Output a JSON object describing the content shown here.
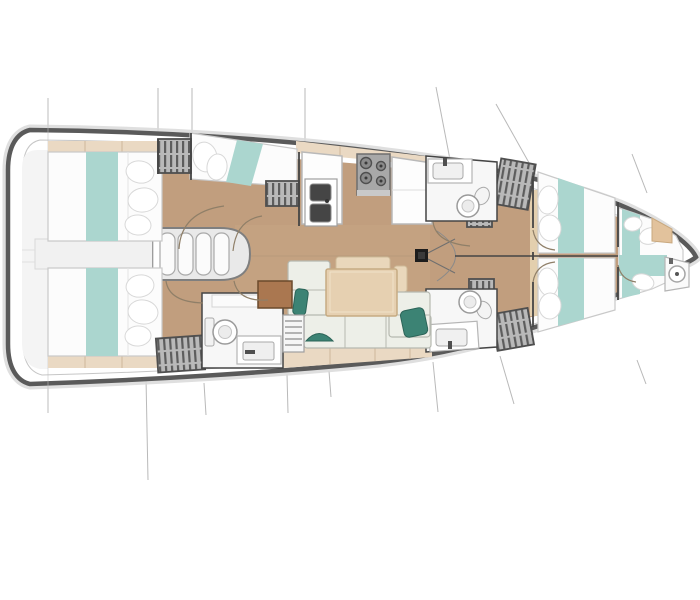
{
  "meta": {
    "title": "Sailboat interior layout plan",
    "type": "floorplan",
    "view": "top-down",
    "orientation": "bow-right"
  },
  "palette": {
    "page": "#ffffff",
    "hull_outline": "#5a5a5a",
    "hull_shadow": "#d9d9d9",
    "hull_inner_line": "#c6c6c6",
    "deck": "#ffffff",
    "transom": "#f4f4f4",
    "floor_wood": "#c19e7e",
    "floor_wood_light": "#cdab89",
    "forepeak_floor": "#efefef",
    "trim_beige": "#ead9c3",
    "trim_line": "#cdb69b",
    "shelf_tan": "#e3cfae",
    "locker_tan": "#e2c29c",
    "mattress": "#fcfcfc",
    "mattress_line": "#c9c9c9",
    "runner_teal": "#abd6cf",
    "pillow_teal": "#3c8374",
    "pillow_teal_line": "#2c6458",
    "cushion": "#edefe8",
    "cushion_line": "#b6b9b0",
    "backrest_tan": "#e9d7bb",
    "backrest_line": "#cfbb99",
    "table_wood": "#e6d0b1",
    "table_line": "#c6ab83",
    "wardrobe_fill": "#b9b9b9",
    "wardrobe_mark": "#5d5d5d",
    "wardrobe_frame": "#4f4f4f",
    "fixture_white": "#f7f7f7",
    "fixture_line": "#9a9a9a",
    "counter_white": "#fdfdfd",
    "counter_line": "#b9b9b9",
    "stove_gray": "#a8a8a8",
    "stove_line": "#6e6e6e",
    "burner_gray": "#8b8b8b",
    "basin_dark": "#454545",
    "stairs_frame": "#7f7f7f",
    "stairs_fill": "#e9e9e9",
    "tread_white": "#fbfbfb",
    "mast_black": "#1d1d1d",
    "wall": "#454545",
    "door_arc": "#8f7f68",
    "section_line": "#b9b9b9",
    "ottoman_brown": "#aa7750",
    "ottoman_line": "#6b4a2c"
  },
  "layout": {
    "areas": [
      {
        "name": "aft-cabin-port",
        "features": [
          "transom-double-berth",
          "teal-runner",
          "hanging-wardrobe",
          "second-berth-angled",
          "hanging-wardrobe-2"
        ]
      },
      {
        "name": "aft-cabin-starboard",
        "features": [
          "transom-double-berth",
          "teal-runner",
          "hanging-wardrobe",
          "ensuite-head"
        ]
      },
      {
        "name": "companionway",
        "features": [
          "four-steps",
          "landing",
          "cockpit-passage"
        ]
      },
      {
        "name": "galley",
        "features": [
          "double-sink",
          "four-burner-stove",
          "counter-left",
          "counter-right",
          "shelf-strip"
        ]
      },
      {
        "name": "saloon",
        "features": [
          "u-settee",
          "dining-table",
          "teal-pillow-x3",
          "ottoman-brown",
          "slatted-seat",
          "backrest"
        ]
      },
      {
        "name": "head-aft-starboard",
        "features": [
          "toilet",
          "sink-counter",
          "shelf"
        ]
      },
      {
        "name": "head-forward-port",
        "features": [
          "toilet",
          "sink-counter"
        ]
      },
      {
        "name": "head-forward-starboard",
        "features": [
          "toilet",
          "sink-counter"
        ]
      },
      {
        "name": "forward-cabin-port",
        "features": [
          "berth",
          "teal-runner",
          "pillows",
          "wardrobe",
          "side-shelf"
        ]
      },
      {
        "name": "forward-cabin-starboard",
        "features": [
          "berth",
          "teal-runner",
          "pillows",
          "wardrobe",
          "side-shelf"
        ]
      },
      {
        "name": "forepeak-cabin",
        "features": [
          "athwartship-berth",
          "teal-runner-cross",
          "washbasin-bow",
          "tan-locker"
        ]
      },
      {
        "name": "mast-step",
        "features": [
          "mast",
          "rigging-lines",
          "door-arcs"
        ]
      }
    ],
    "section_lines_count": 13
  }
}
